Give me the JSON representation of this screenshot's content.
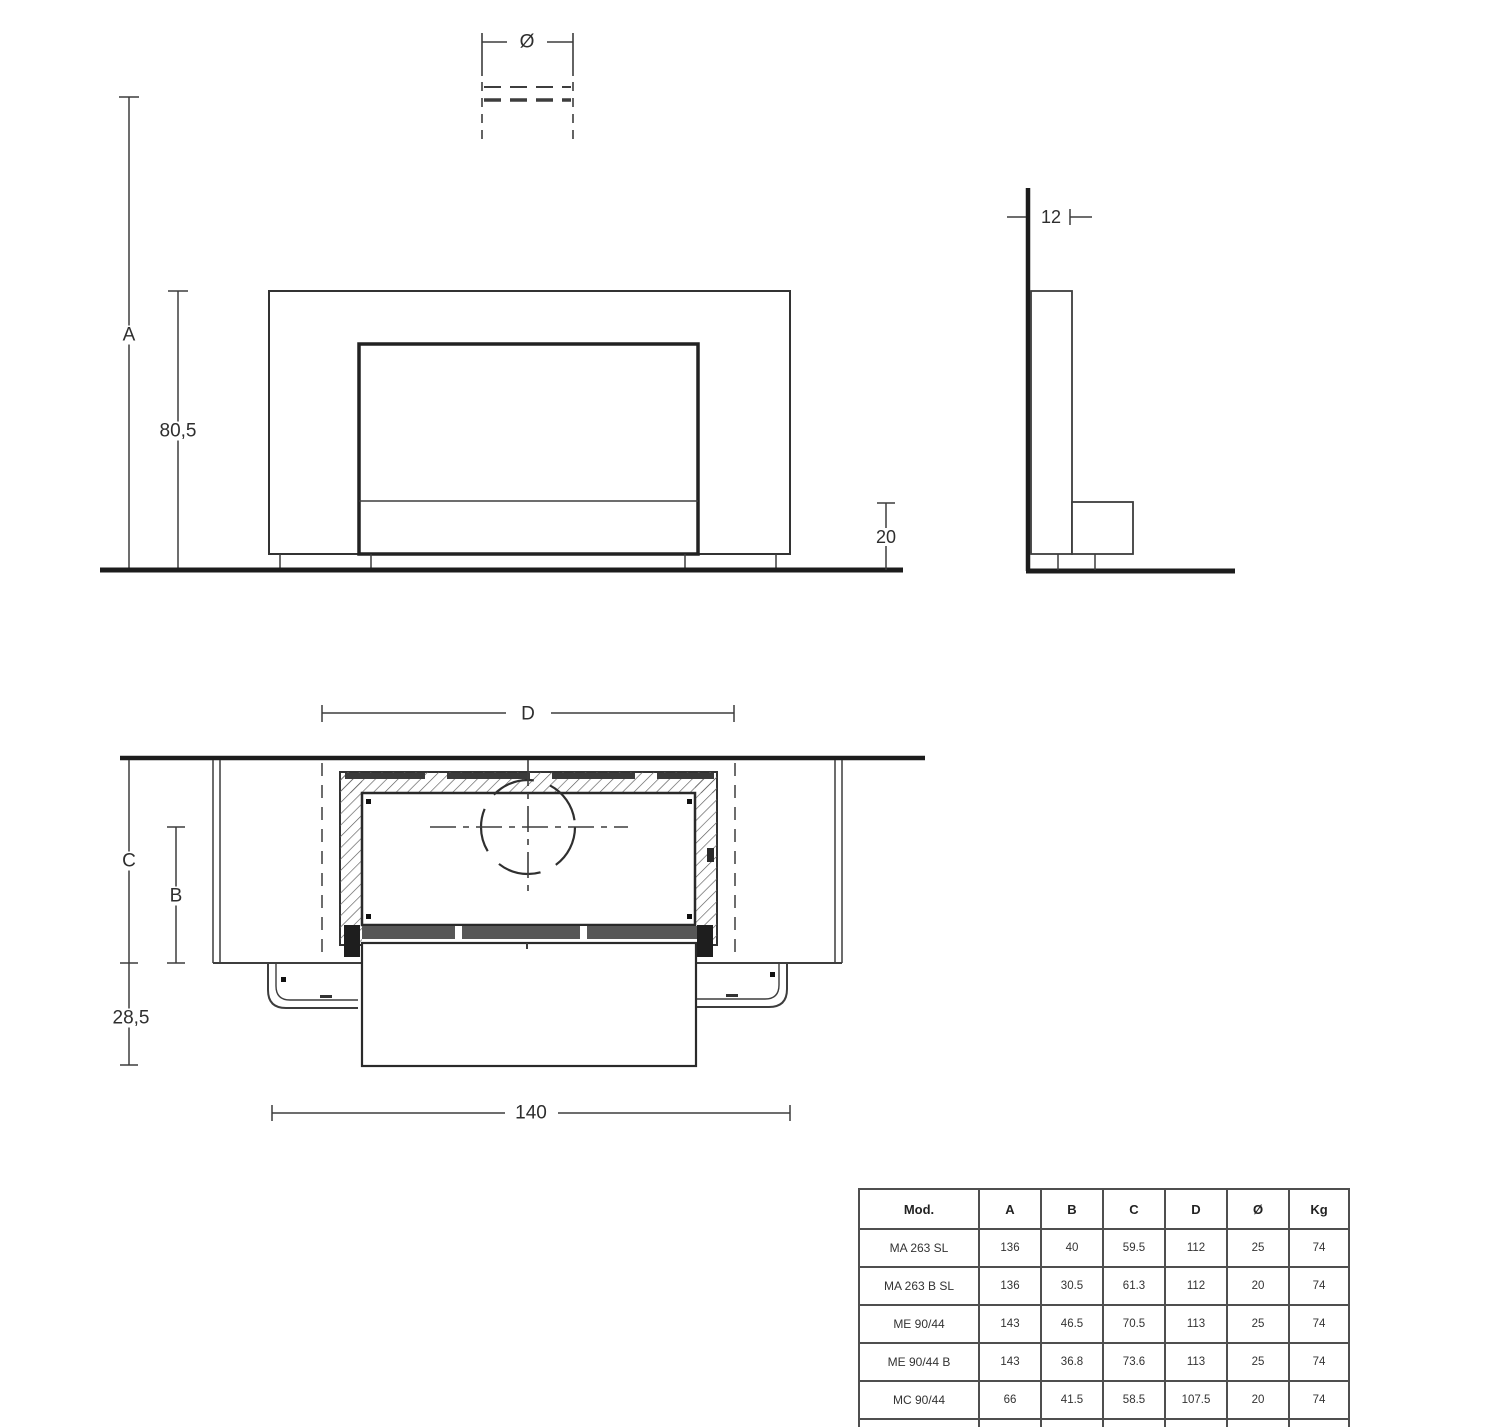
{
  "front_view": {
    "flue_diameter_label": "Ø",
    "overall_height_label": "A",
    "opening_height_value": "80,5",
    "base_height_value": "20"
  },
  "side_view": {
    "upper_depth_value": "12"
  },
  "plan_view": {
    "niche_width_label": "D",
    "total_depth_label": "C",
    "firebox_depth_label": "B",
    "hearth_projection_value": "28,5",
    "overall_width_value": "140"
  },
  "table": {
    "headers": [
      "Mod.",
      "A",
      "B",
      "C",
      "D",
      "Ø",
      "Kg"
    ],
    "rows": [
      [
        "MA 263 SL",
        "136",
        "40",
        "59.5",
        "112",
        "25",
        "74"
      ],
      [
        "MA 263 B SL",
        "136",
        "30.5",
        "61.3",
        "112",
        "20",
        "74"
      ],
      [
        "ME 90/44",
        "143",
        "46.5",
        "70.5",
        "113",
        "25",
        "74"
      ],
      [
        "ME 90/44 B",
        "143",
        "36.8",
        "73.6",
        "113",
        "25",
        "74"
      ],
      [
        "MC 90/44",
        "66",
        "41.5",
        "58.5",
        "107.5",
        "20",
        "74"
      ],
      [
        "IG 90",
        "71.5",
        "32",
        "49.5",
        "103",
        "15",
        "74"
      ]
    ]
  }
}
